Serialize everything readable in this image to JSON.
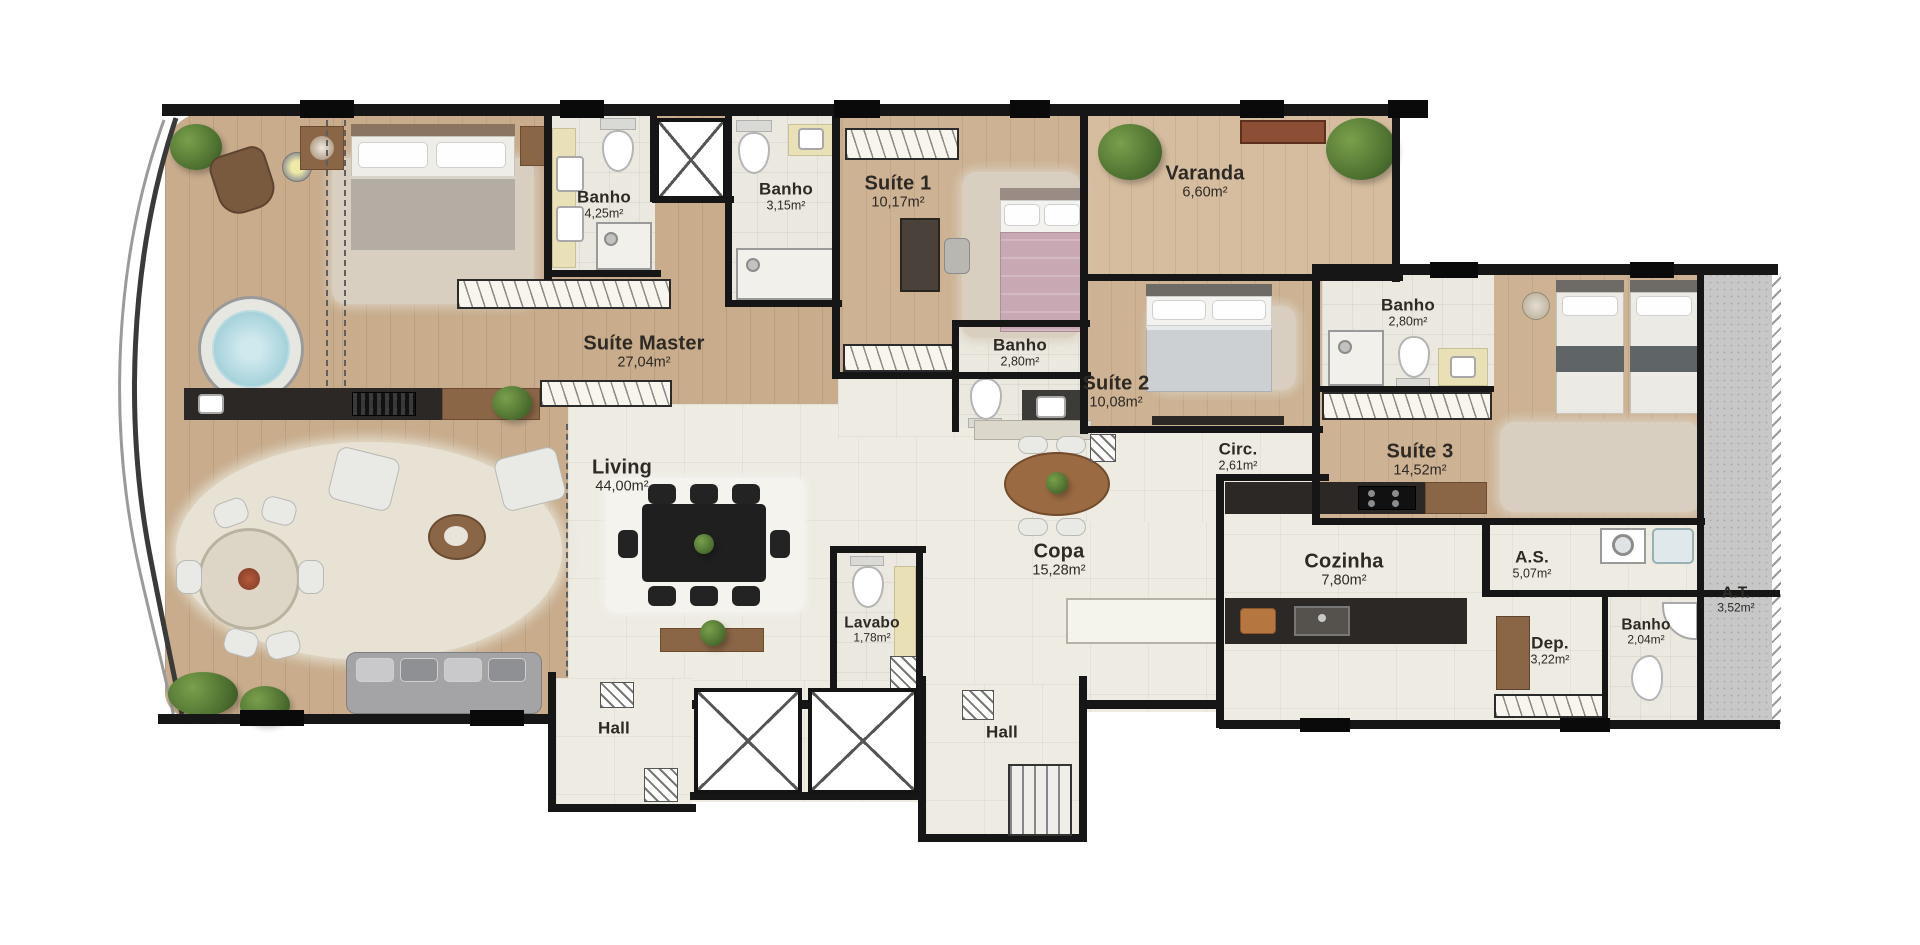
{
  "plan": {
    "rooms": {
      "suite_master": {
        "name": "Suíte Master",
        "area": "27,04m²"
      },
      "banho_master": {
        "name": "Banho",
        "area": "4,25m²"
      },
      "banho_social": {
        "name": "Banho",
        "area": "3,15m²"
      },
      "suite_1": {
        "name": "Suíte 1",
        "area": "10,17m²"
      },
      "varanda": {
        "name": "Varanda",
        "area": "6,60m²"
      },
      "banho_suite_2": {
        "name": "Banho",
        "area": "2,80m²"
      },
      "suite_2": {
        "name": "Suíte 2",
        "area": "10,08m²"
      },
      "banho_suite_3": {
        "name": "Banho",
        "area": "2,80m²"
      },
      "circ": {
        "name": "Circ.",
        "area": "2,61m²"
      },
      "suite_3": {
        "name": "Suíte 3",
        "area": "14,52m²"
      },
      "living": {
        "name": "Living",
        "area": "44,00m²"
      },
      "lavabo": {
        "name": "Lavabo",
        "area": "1,78m²"
      },
      "copa": {
        "name": "Copa",
        "area": "15,28m²"
      },
      "cozinha": {
        "name": "Cozinha",
        "area": "7,80m²"
      },
      "servico": {
        "name": "A.S.",
        "area": "5,07m²"
      },
      "deposito": {
        "name": "Dep.",
        "area": "3,22m²"
      },
      "banho_servico": {
        "name": "Banho",
        "area": "2,04m²"
      },
      "area_tecnica": {
        "name": "A.T.",
        "area": "3,52m²"
      },
      "hall_left": {
        "name": "Hall",
        "area": ""
      },
      "hall_right": {
        "name": "Hall",
        "area": ""
      }
    },
    "colors": {
      "wall": "#161616",
      "wood": "#c8ac8c",
      "wood_light": "#d6bd9f",
      "tile": "#ebe8df",
      "living_floor": "#edebe2",
      "technical_gray": "#c7c7c7",
      "label_text": "#2d2925",
      "plant_green": "#4d7030"
    }
  }
}
